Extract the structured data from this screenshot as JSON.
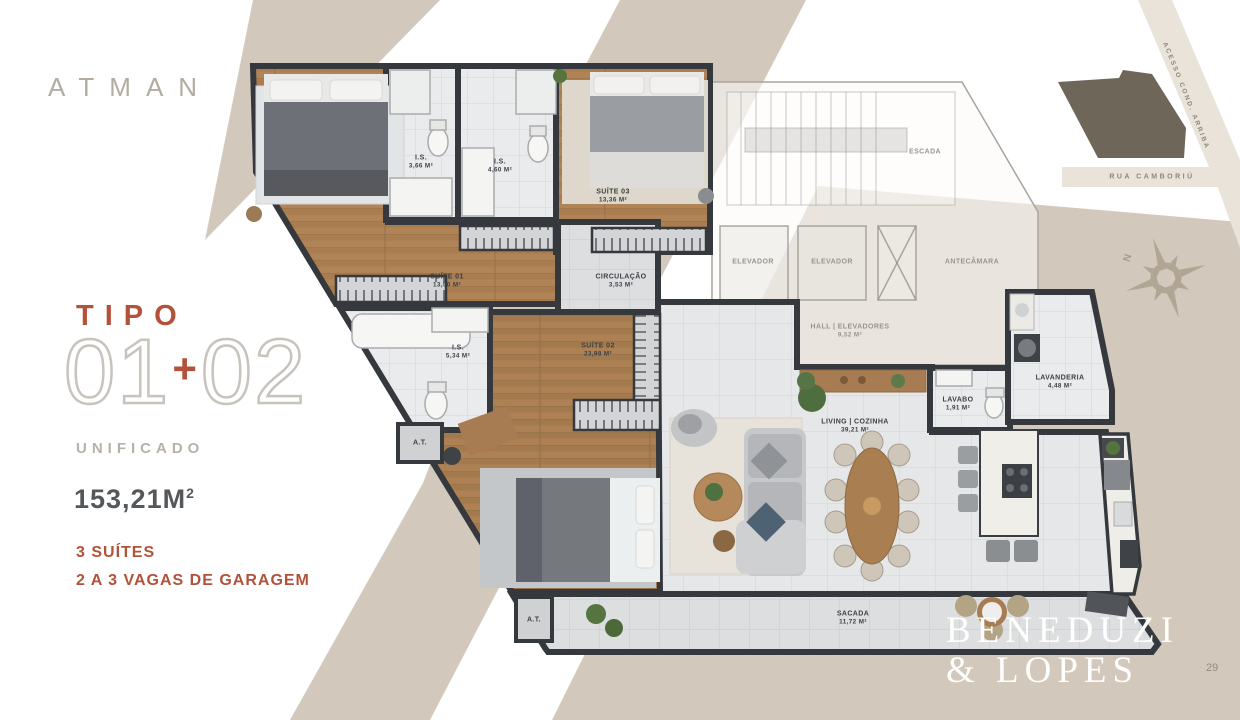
{
  "brand": {
    "logo_text": "ATMAN"
  },
  "panel": {
    "tipo": "TIPO",
    "num_left": "01",
    "plus": "+",
    "num_right": "02",
    "subtitle": "UNIFICADO",
    "area_value": "153,21M",
    "area_exp": "2",
    "feature_suites": "3 SUÍTES",
    "feature_garage": "2 A 3 VAGAS DE GARAGEM"
  },
  "labels": [
    {
      "name": "SUÍTE 01",
      "area": "13,50 M²"
    },
    {
      "name": "I.S.",
      "area": "3,66 M²"
    },
    {
      "name": "I.S.",
      "area": "4,60 M²"
    },
    {
      "name": "SUÍTE 03",
      "area": "13,36 M²"
    },
    {
      "name": "CIRCULAÇÃO",
      "area": "3,53 M²"
    },
    {
      "name": "I.S.",
      "area": "5,34 M²"
    },
    {
      "name": "SUÍTE 02",
      "area": "23,98 M²"
    },
    {
      "name": "LIVING | COZINHA",
      "area": "39,21 M²"
    },
    {
      "name": "LAVABO",
      "area": "1,91 M²"
    },
    {
      "name": "LAVANDERIA",
      "area": "4,48 M²"
    },
    {
      "name": "SACADA",
      "area": "11,72 M²"
    },
    {
      "name": "A.T.",
      "area": ""
    },
    {
      "name": "A.T.",
      "area": ""
    },
    {
      "name": "HALL | ELEVADORES",
      "area": "9,52 M²"
    },
    {
      "name": "ESCADA",
      "area": ""
    },
    {
      "name": "ELEVADOR",
      "area": ""
    },
    {
      "name": "ELEVADOR",
      "area": ""
    },
    {
      "name": "ANTECÂMARA",
      "area": ""
    }
  ],
  "map": {
    "road_diagonal": "ACESSO COND. ARRIBA",
    "road_horizontal": "RUA CAMBORIÚ",
    "compass_n": "N"
  },
  "footer": {
    "brand_line1": "BENEDUZI",
    "brand_line2": "& LOPES",
    "page_number": "29"
  },
  "colors": {
    "accent": "#b3523a",
    "beige_band": "#d2c9bc",
    "wall": "#35383d",
    "wood_floor": "#b08757",
    "lot_dark": "#6d6659"
  }
}
